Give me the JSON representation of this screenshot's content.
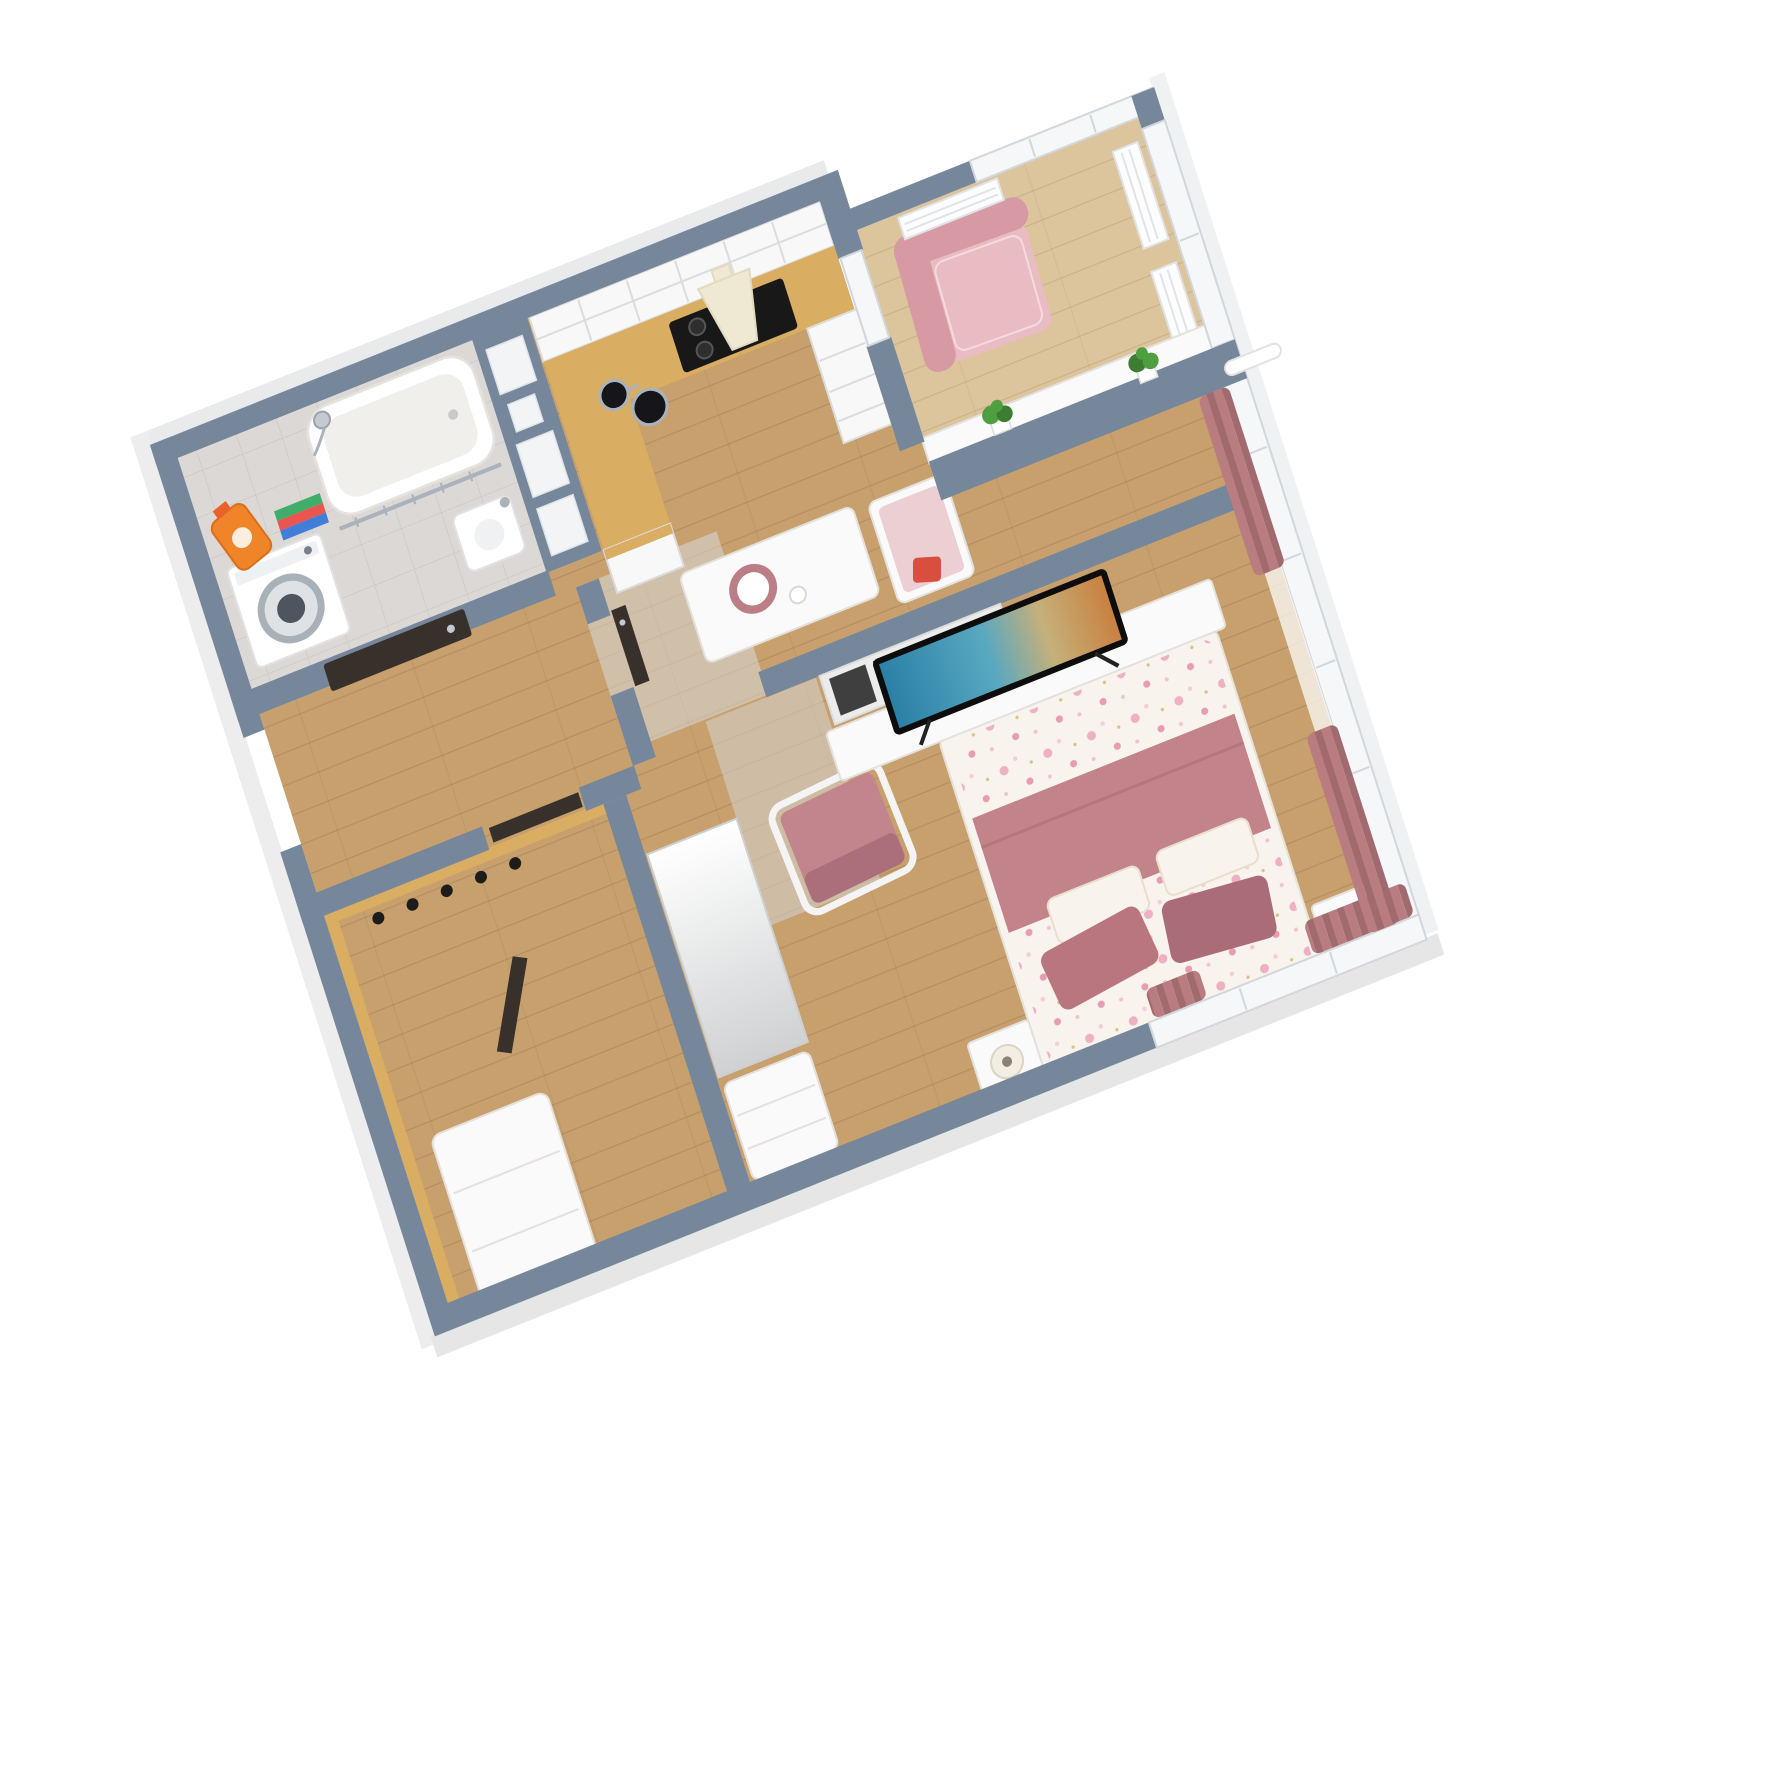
{
  "scene": {
    "type": "3d-isometric-floorplan-render",
    "subject": "one-bedroom apartment cutaway floor plan, top-down axonometric view",
    "background": "#ffffff"
  },
  "palette": {
    "wall": "#76879b",
    "win": "#f6f7f8",
    "frame": "#d2d7dc",
    "wood": "#c7a06e",
    "woodLight": "#dcc49c",
    "plank": "#7c5f33",
    "tileFloor": "#dcd8d5",
    "screed": "#d6d4d1",
    "counter": "#d9ad62",
    "cab": "#f8f8f8",
    "cabLine": "#dcdcdc",
    "whiteFurn": "#fbfafa",
    "whiteFurnLine": "#e4e1dd",
    "door": "#38302a",
    "hood": "#efe8d2",
    "cooktop": "#181818",
    "armchair": "#e9bcc3",
    "armchairDark": "#d79aa5",
    "chairPink": "#c2848d",
    "chairPinkDark": "#aa6f7a",
    "blanket": "#c2838b",
    "pillow": "#b9767f",
    "pillowDark": "#aa6d78",
    "floralBg": "#f8f3ec",
    "cushion": "#eccfd3",
    "curtain": "#b97c80",
    "curtainDark": "#a06a6e",
    "plant": "#4f9e3f",
    "plantDark": "#3c7d31",
    "metal": "#aab2bb",
    "accentRed": "#d94f3f",
    "tvTeal": "#2a7fa5",
    "tvSand": "#c97f3e"
  },
  "rooms": [
    {
      "name": "bathroom",
      "furniture": [
        "washing-machine",
        "bathtub",
        "sink",
        "towel-rail",
        "shower-head",
        "detergent-bottle",
        "towel-stack"
      ]
    },
    {
      "name": "kitchen",
      "furniture": [
        "upper-glass-cabinets",
        "range-hood",
        "cooktop",
        "kitchen-counter",
        "pots",
        "drawer-cabinet",
        "side-cabinet"
      ]
    },
    {
      "name": "balcony",
      "furniture": [
        "pink-armchair",
        "radiators",
        "window-wall",
        "potted-plants",
        "parapet-cabinet"
      ]
    },
    {
      "name": "hallway",
      "furniture": [
        "entry-door",
        "interior-door",
        "coat-hooks"
      ]
    },
    {
      "name": "closet-room",
      "furniture": [
        "wood-paneling",
        "closet-door",
        "shoe-bench"
      ]
    },
    {
      "name": "living-bedroom",
      "furniture": [
        "dining-table",
        "plate",
        "dining-bench",
        "tv-partition",
        "shelf-cubbies",
        "tv",
        "tv-stand",
        "lounge-chair",
        "wardrobe",
        "bench-sofa",
        "double-bed",
        "pink-blanket",
        "pillows",
        "nightstand-left",
        "nightstand-right",
        "lamps",
        "rose-curtains",
        "sheer-curtain",
        "curtain-rod"
      ]
    }
  ]
}
